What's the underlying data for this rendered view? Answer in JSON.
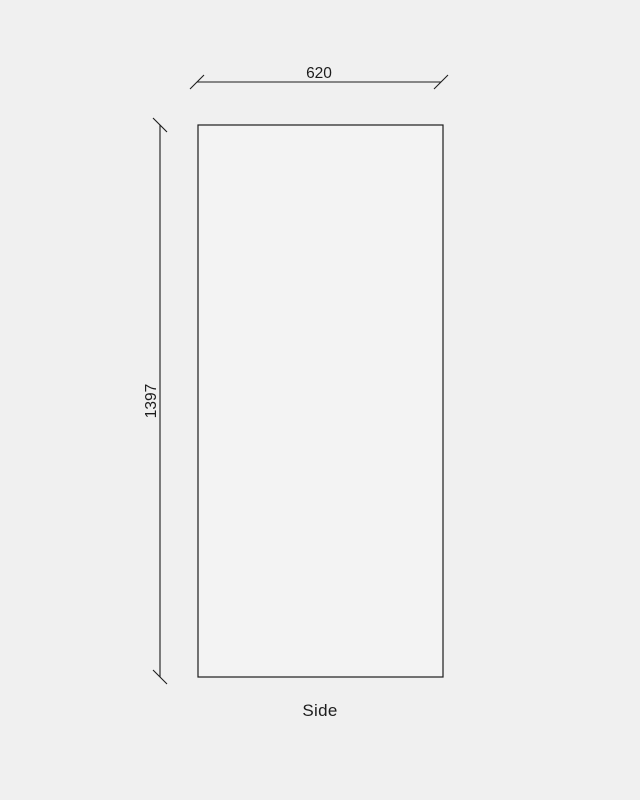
{
  "drawing": {
    "view_label": "Side",
    "dimensions": {
      "width": "620",
      "height": "1397"
    }
  },
  "colors": {
    "background": "#f0f0f0",
    "panel_fill": "#f3f3f3",
    "line": "#1c1c1c",
    "text": "#1c1c1c"
  }
}
